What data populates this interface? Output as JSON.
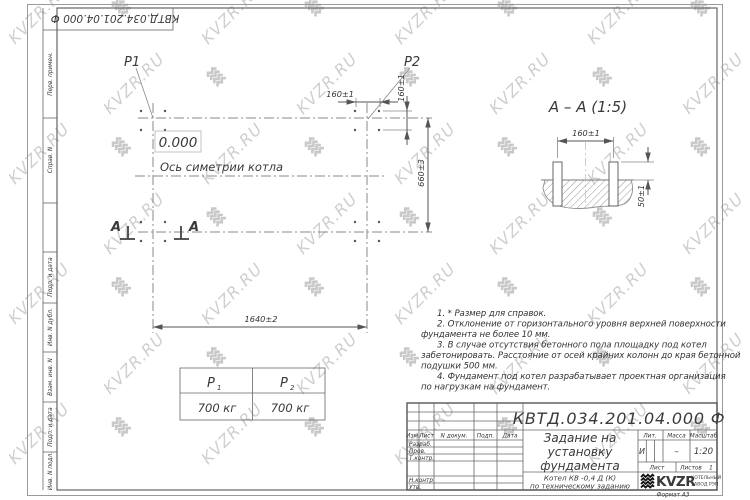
{
  "colors": {
    "line": "#666666",
    "text": "#333333",
    "watermark": "#cfcfcf",
    "logo": "#111111"
  },
  "watermark": {
    "text": "KVZR.RU"
  },
  "corner_stamp": {
    "doc_number": "КВТД.034.201.04.000  Ф"
  },
  "side_strip": {
    "labels": [
      "Перв. примен.",
      "Справ. N",
      "Подп. и дата",
      "Инв. N дубл.",
      "Взам. инв. N",
      "Подп. и дата",
      "Инв. N подл."
    ]
  },
  "plan": {
    "p1_label": "P1",
    "p2_label": "P2",
    "elevation": "0.000",
    "axis_label": "Ось симетрии котла",
    "section_letter": "A"
  },
  "dims": {
    "d160": "160±1",
    "d660": "660±3",
    "d1640": "1640±2",
    "d50": "50±1"
  },
  "section_view": {
    "title": "A – A (1:5)"
  },
  "notes": {
    "lines": [
      "1. * Размер для справок.",
      "2. Отклонение от горизонтального уровня верхней поверхности",
      "фундамента не более 10 мм.",
      "3. В случае отсутствия бетонного пола площадку под котел",
      "забетонировать. Расстояние от осей крайних колонн до края бетонной",
      "подушки 500 мм.",
      "4. Фундамент под котел разрабатывает проектная организация",
      "по нагрузкам на фундамент."
    ]
  },
  "load_table": {
    "col1": {
      "p": "P",
      "sub": "1",
      "value": "700 кг"
    },
    "col2": {
      "p": "P",
      "sub": "2",
      "value": "700 кг"
    }
  },
  "title_block": {
    "doc_number": "КВТД.034.201.04.000  Ф",
    "title_line1": "Задание на",
    "title_line2": "установку",
    "title_line3": "фундамента",
    "subtitle_line1": "Котел  КВ -0,4  Д  (К)",
    "subtitle_line2": "по техническому заданию",
    "rev_headers": [
      "Изм.",
      "Лист",
      "N докум.",
      "Подп.",
      "Дата"
    ],
    "sign_labels": [
      "Разраб.",
      "Пров.",
      "Т.контр.",
      "Н.контр.",
      "Утв."
    ],
    "lit_header": "Лит.",
    "mass_header": "Масса",
    "scale_header": "Масштаб",
    "lit_value": "И",
    "mass_value": "–",
    "scale_value": "1:20",
    "sheet_label": "Лист",
    "sheets_label": "Листов",
    "sheets_value": "1",
    "logo_text": "KVZR",
    "logo_caption_line1": "КОТЕЛЬНЫЙ",
    "logo_caption_line2": "ЗАВОД РЭП",
    "format_label": "Формат А3"
  }
}
